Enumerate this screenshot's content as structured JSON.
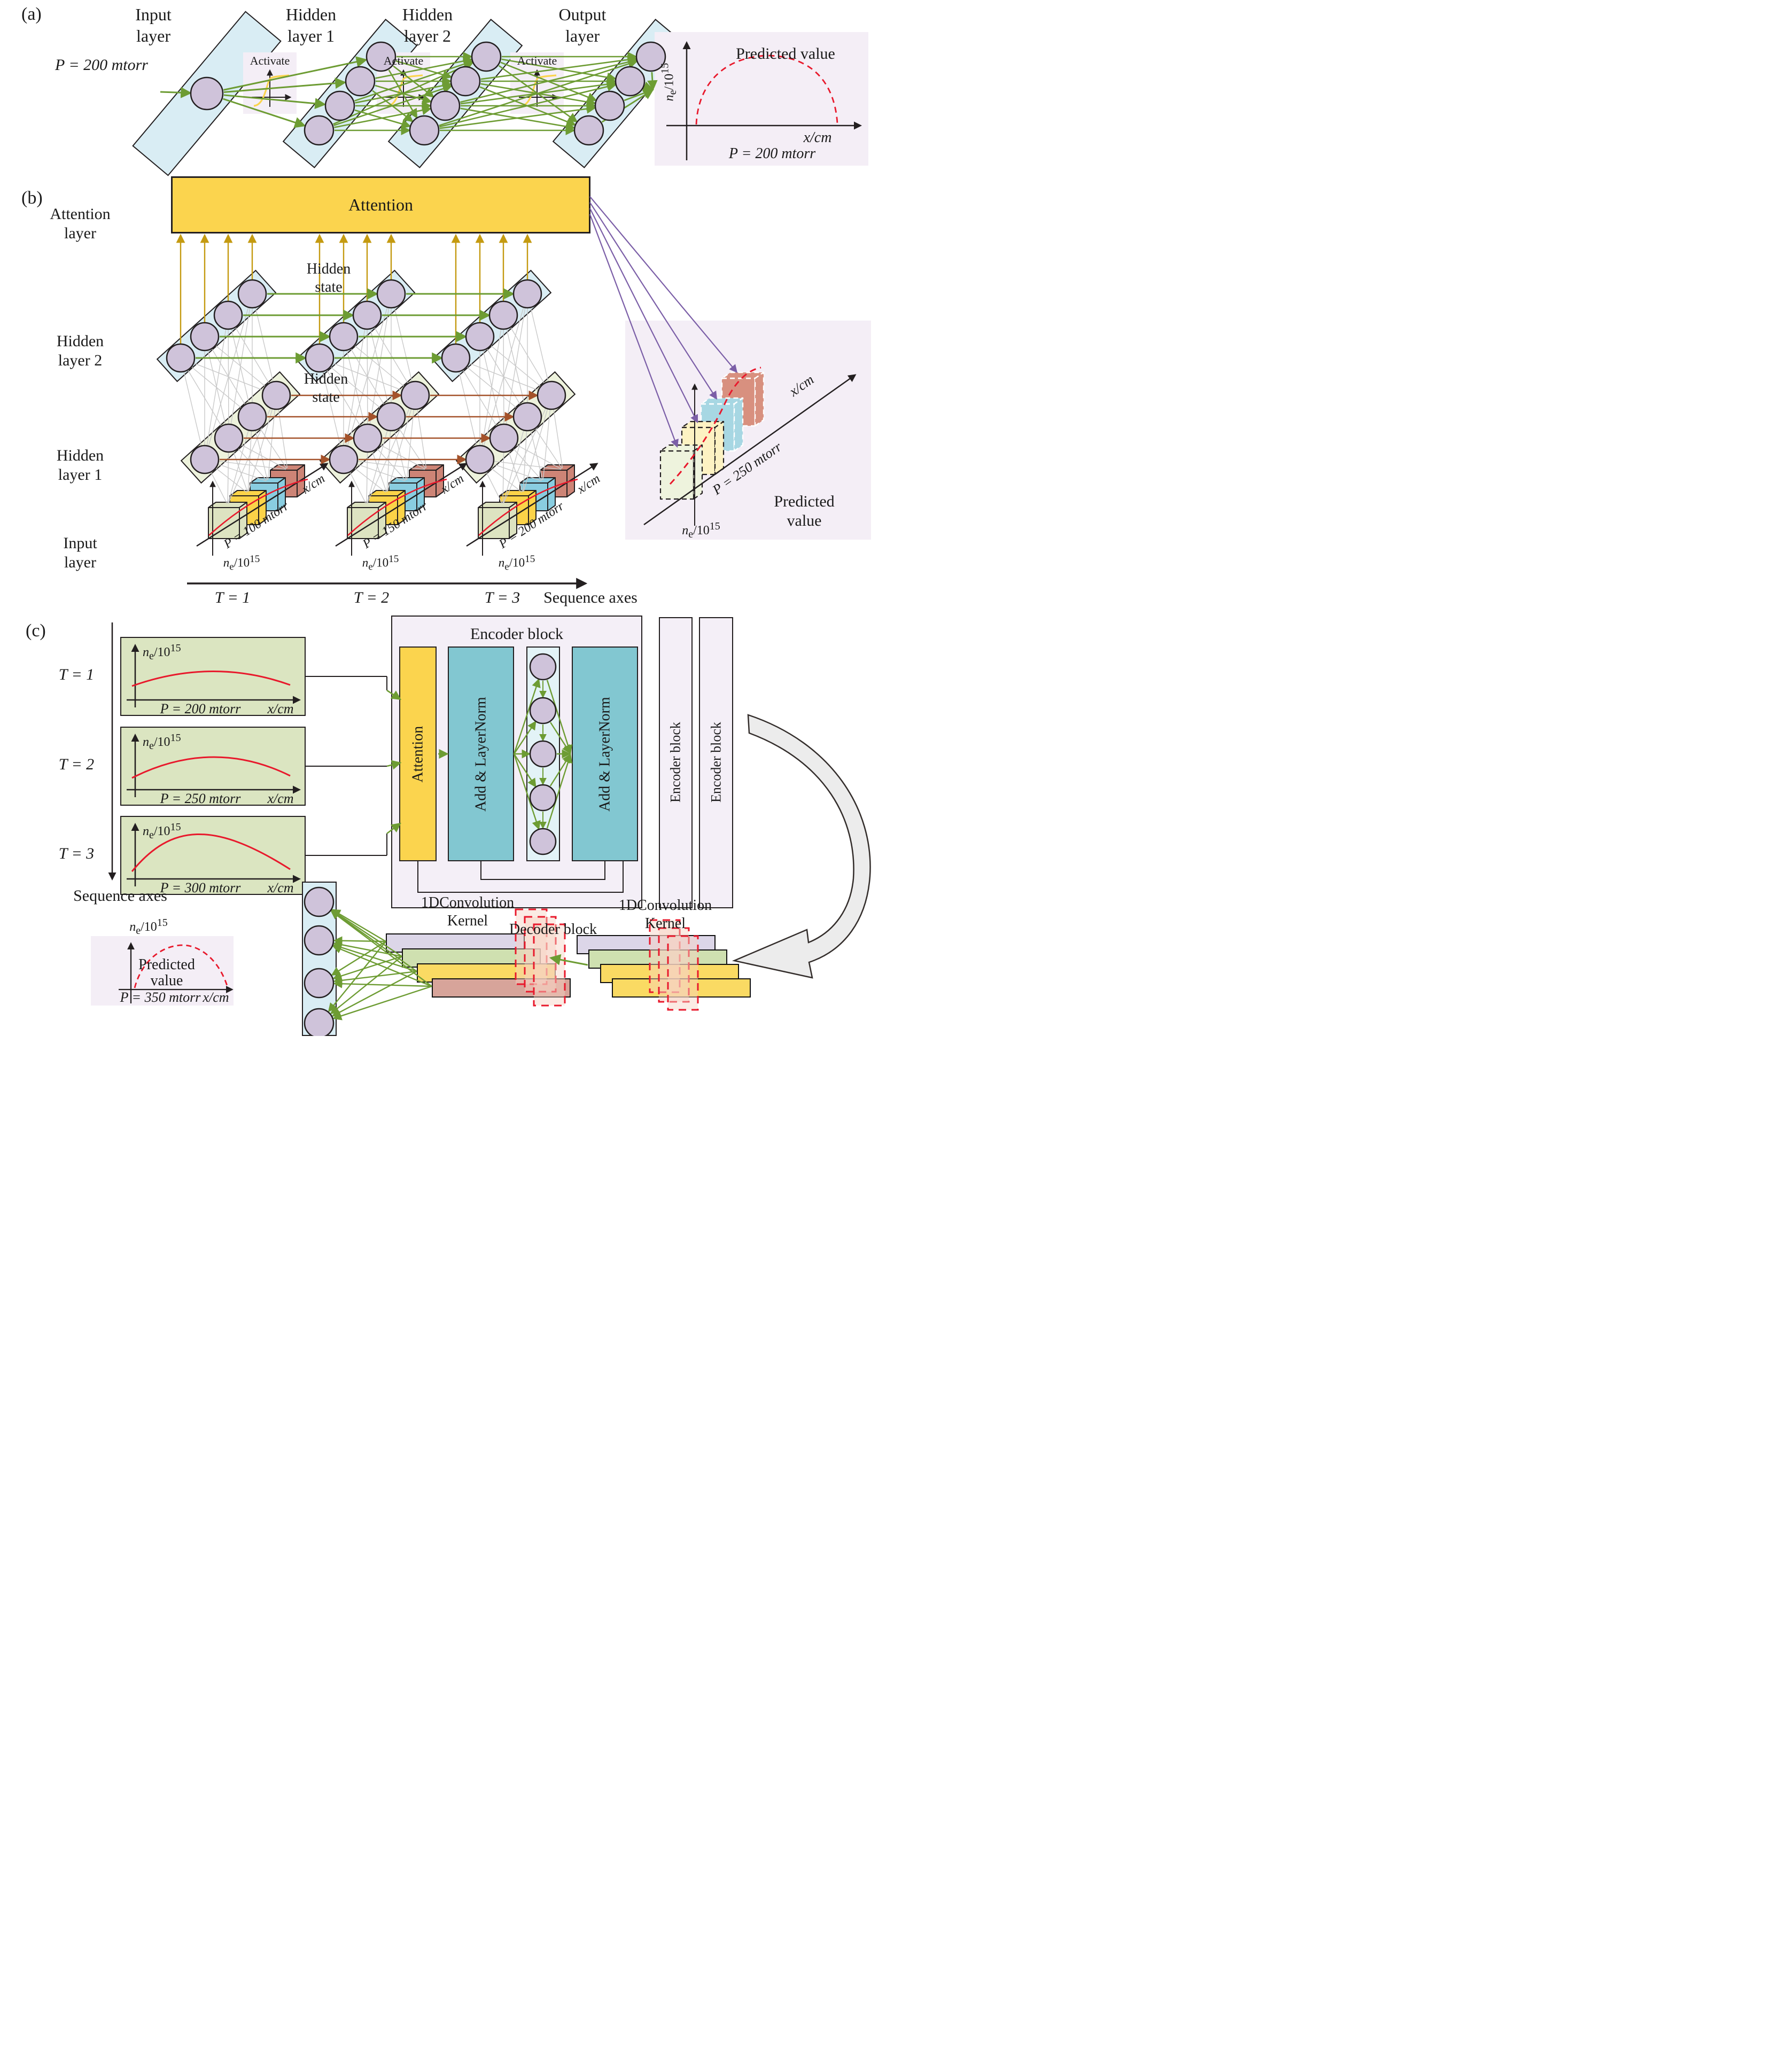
{
  "math": {
    "base": "n",
    "sub": "e",
    "slash": "/",
    "pow": "10",
    "sup": "15"
  },
  "colors": {
    "layer_blue": "#d9edf4",
    "layer_cream": "#edf2dc",
    "node_purple": "#cfc3da",
    "arrow_green": "#6d9c33",
    "arrow_gold": "#c49a10",
    "arrow_brown": "#a4522a",
    "arrow_purple": "#7b5ea7",
    "attention_yellow": "#fbd44e",
    "teal": "#82c7d1",
    "panel_lavender": "#f4eef6",
    "tbox_green": "#dbe5c1",
    "curve_red": "#e8192c"
  },
  "panel_a": {
    "tag": "(a)",
    "layer_labels": {
      "input": [
        "Input",
        "layer"
      ],
      "hidden1": [
        "Hidden",
        "layer 1"
      ],
      "hidden2": [
        "Hidden",
        "layer 2"
      ],
      "output": [
        "Output",
        "layer"
      ]
    },
    "pressure": "P = 200 mtorr",
    "activate_label": "Activate",
    "predicted": {
      "title": "Predicted value",
      "xlabel": "x/cm",
      "pressure": "P = 200 mtorr"
    }
  },
  "panel_b": {
    "tag": "(b)",
    "attention_layer": [
      "Attention",
      "layer"
    ],
    "attention_box": "Attention",
    "hidden_state": [
      "Hidden",
      "state"
    ],
    "hidden_layer2": [
      "Hidden",
      "layer 2"
    ],
    "hidden_layer1": [
      "Hidden",
      "layer 1"
    ],
    "input_layer": [
      "Input",
      "layer"
    ],
    "timesteps": [
      {
        "label": "T = 1",
        "pressure": "P = 100 mtorr",
        "xlabel": "x/cm"
      },
      {
        "label": "T = 2",
        "pressure": "P = 150 mtorr",
        "xlabel": "x/cm"
      },
      {
        "label": "T = 3",
        "pressure": "P = 200 mtorr",
        "xlabel": "x/cm"
      }
    ],
    "sequence_axes": "Sequence axes",
    "predicted": {
      "pressure": "P = 250 mtorr",
      "xlabel": "x/cm",
      "title": [
        "Predicted",
        "value"
      ]
    }
  },
  "panel_c": {
    "tag": "(c)",
    "timesteps": [
      {
        "label": "T = 1",
        "pressure": "P = 200 mtorr",
        "xlabel": "x/cm"
      },
      {
        "label": "T = 2",
        "pressure": "P = 250 mtorr",
        "xlabel": "x/cm"
      },
      {
        "label": "T = 3",
        "pressure": "P = 300 mtorr",
        "xlabel": "x/cm"
      }
    ],
    "sequence_axes": "Sequence axes",
    "encoder": {
      "title": "Encoder block",
      "attention": "Attention",
      "add_layernorm_1": "Add & LayerNorm",
      "add_layernorm_2": "Add & LayerNorm",
      "block_2": "Encoder block",
      "block_3": "Encoder block"
    },
    "decoder": {
      "conv_kernel_1": [
        "1DConvolution",
        "Kernel"
      ],
      "block": "Decoder block",
      "conv_kernel_2": [
        "1DConvolution",
        "Kernel"
      ]
    },
    "predicted": {
      "title": [
        "Predicted",
        "value"
      ],
      "pressure": "P = 350 mtorr",
      "xlabel": "x/cm"
    }
  }
}
